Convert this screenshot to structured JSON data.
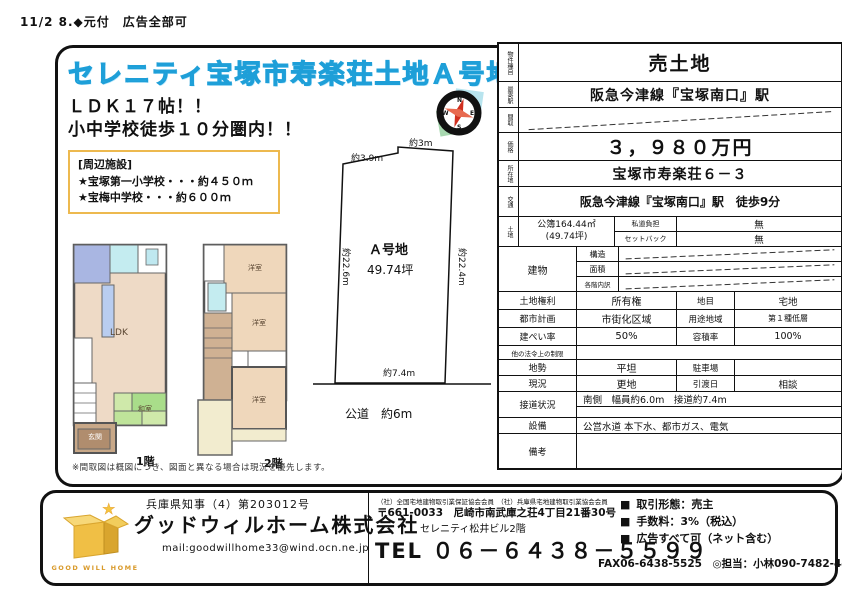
{
  "page": {
    "header_note": "11/2 8.◆元付　広告全部可"
  },
  "flyer": {
    "title": "セレニティ宝塚市寿楽荘土地Ａ号地",
    "catch_lines": [
      "ＬＤＫ１７帖！！",
      "小中学校徒歩１０分圏内！！"
    ],
    "facilities": {
      "heading": "[周辺施設]",
      "items": [
        "★宝塚第一小学校・・・約４５０ｍ",
        "★宝梅中学校・・・約６００ｍ"
      ]
    },
    "plot": {
      "label": "Ａ号地",
      "area": "49.74坪",
      "edge_top_left": "約3.9m",
      "edge_top_right": "約3m",
      "edge_left": "約22.6m",
      "edge_right": "約22.4m",
      "edge_bottom": "約7.4m",
      "road": "公道　約6m"
    },
    "floorplan": {
      "floor1_label": "1階",
      "floor2_label": "2階",
      "room_ldk": "LDK",
      "room_genkan": "玄関",
      "room_washitsu": "和室",
      "room_yoshitsu": "洋室",
      "note": "※間取図は概図につき、図面と異なる場合は現況を優先します。"
    }
  },
  "spec": {
    "property_type": {
      "label": "物件種目",
      "value": "売土地"
    },
    "station": {
      "label": "最寄駅",
      "value": "阪急今津線『宝塚南口』駅"
    },
    "madori": {
      "label": "間取",
      "value": ""
    },
    "price": {
      "label": "価格",
      "value": "３，９８０万円"
    },
    "address": {
      "label": "所在地",
      "value": "宝塚市寿楽荘６－３"
    },
    "access": {
      "label": "交通",
      "value": "阪急今津線『宝塚南口』駅　徒歩9分"
    },
    "land": {
      "label": "土地",
      "area": "公簿164.44㎡",
      "tsubo": "(49.74坪)",
      "private_road": {
        "label": "私道負担",
        "value": "無"
      },
      "setback": {
        "label": "セットバック",
        "value": "無"
      }
    },
    "building": {
      "label": "建物",
      "structure_label": "構造",
      "area_label": "面積",
      "floors_label": "各階内訳"
    },
    "rights": {
      "label": "土地権利",
      "value": "所有権"
    },
    "chimoku": {
      "label": "地目",
      "value": "宅地"
    },
    "city_plan": {
      "label": "都市計画",
      "value": "市街化区域"
    },
    "youto": {
      "label": "用途地域",
      "value": "第１種低層"
    },
    "kenpei": {
      "label": "建ぺい率",
      "value": "50%"
    },
    "yoseki": {
      "label": "容積率",
      "value": "100%"
    },
    "other_law": {
      "label": "他の法令上の制限",
      "value": ""
    },
    "chisei": {
      "label": "地勢",
      "value": "平坦"
    },
    "parking": {
      "label": "駐車場",
      "value": ""
    },
    "genkyo": {
      "label": "現況",
      "value": "更地"
    },
    "delivery": {
      "label": "引渡日",
      "value": "相談"
    },
    "setsudo": {
      "label": "接道状況",
      "value": "南側　幅員約6.0m　接道約7.4m"
    },
    "setsubi": {
      "label": "設備",
      "value": "公営水道 本下水、都市ガス、電気"
    },
    "biko": {
      "label": "備考",
      "value": ""
    }
  },
  "footer": {
    "license": "兵庫県知事（4）第203012号",
    "company": "グッドウィルホーム株式会社",
    "mail": "mail:goodwillhome33@wind.ocn.ne.jp",
    "logo_text": "GOOD WILL HOME",
    "memberships": "（社）全国宅地建物取引業保証協会会員　（社）兵庫県宅地建物取引業協会会員",
    "postal_address": "〒661-0033　尼崎市南武庫之荘4丁目21番30号",
    "building_name": "セレニティ松井ビル2階",
    "tel": "TEL ０６－６４３８－５５９９",
    "bullet": "■",
    "deal_type": "取引形態：売主",
    "fee": "手数料：3%（税込）",
    "ad_policy": "広告すべて可（ネット含む）",
    "fax_contact": "FAX06-6438-5525　◎担当：小林090-7482-4405"
  }
}
